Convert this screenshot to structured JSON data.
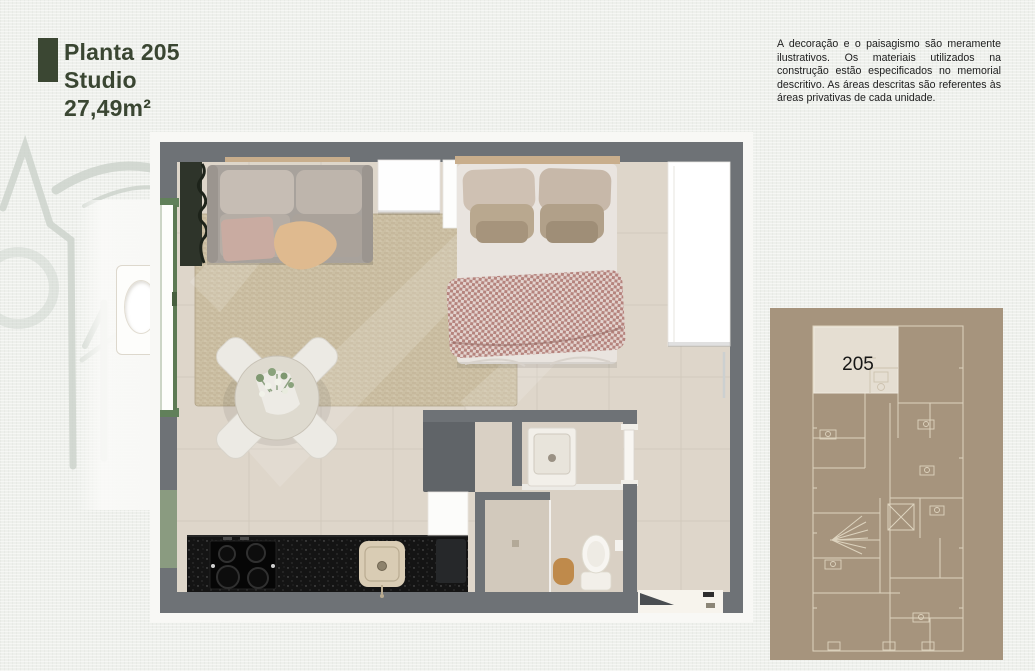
{
  "page": {
    "background": "#eef0ec"
  },
  "header": {
    "accent_color": "#3b4733",
    "title_lines": [
      "Planta 205",
      "Studio",
      "27,49m²"
    ]
  },
  "disclaimer": {
    "text": "A decoração e o paisagismo são meramente ilustrativos. Os materiais utilizados na construção estão especificados no memorial descritivo. As áreas descritas são referentes às áreas privativas de cada unidade."
  },
  "floor_plan": {
    "colors": {
      "wall_gray": "#6e7276",
      "floor_beige": "#ded6ca",
      "rug_beige": "#cbbfa3",
      "counter_black": "#141414",
      "blanket_rose": "#b5837d",
      "window_green": "#5d7a54",
      "panel_green": "#8a9b80"
    }
  },
  "key_plan": {
    "unit_label": "205",
    "background": "#a6947d",
    "line_color": "#e7dfca",
    "highlight_fill": "#e5ded2"
  }
}
